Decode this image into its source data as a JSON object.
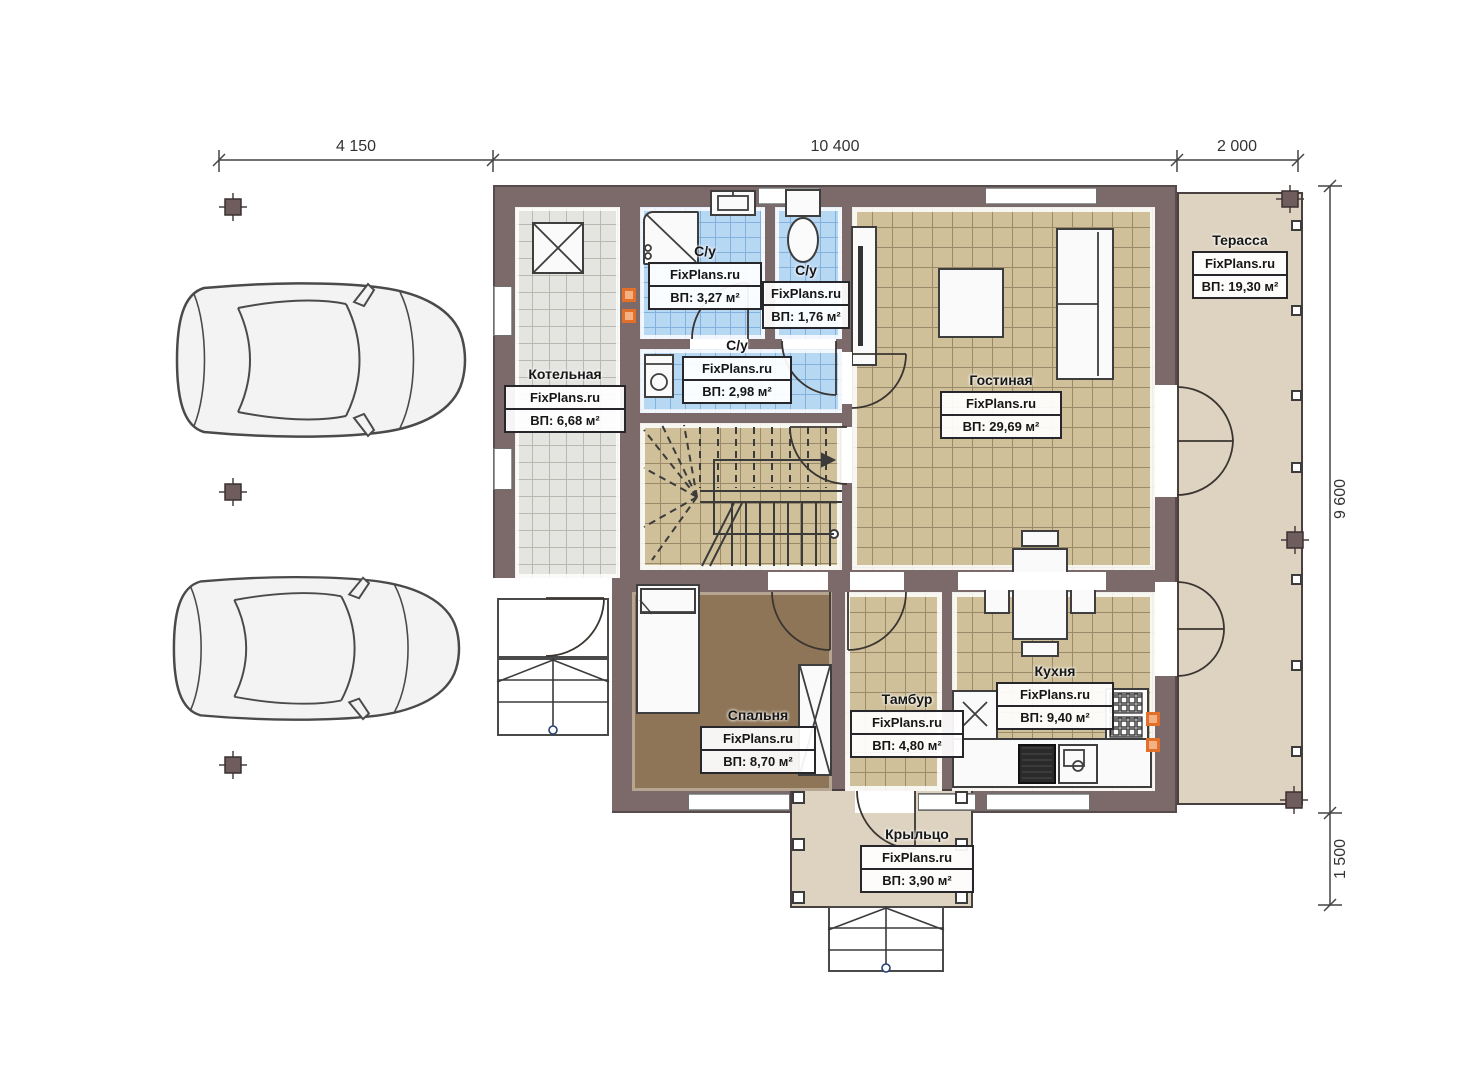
{
  "brand": "FixPlans.ru",
  "dimensions": {
    "top": [
      "4 150",
      "10 400",
      "2 000"
    ],
    "right": [
      "9 600",
      "1 500"
    ]
  },
  "rooms": [
    {
      "key": "boiler",
      "name": "Котельная",
      "area": "ВП: 6,68 м²"
    },
    {
      "key": "bath1",
      "name": "С/у",
      "area": "ВП: 3,27 м²"
    },
    {
      "key": "bath2",
      "name": "С/у",
      "area": "ВП: 1,76 м²"
    },
    {
      "key": "bath3",
      "name": "С/у",
      "area": "ВП: 2,98 м²"
    },
    {
      "key": "living",
      "name": "Гостиная",
      "area": "ВП: 29,69 м²"
    },
    {
      "key": "terrace",
      "name": "Терасса",
      "area": "ВП: 19,30 м²"
    },
    {
      "key": "bedroom",
      "name": "Спальня",
      "area": "ВП: 8,70 м²"
    },
    {
      "key": "tambour",
      "name": "Тамбур",
      "area": "ВП: 4,80 м²"
    },
    {
      "key": "kitchen",
      "name": "Кухня",
      "area": "ВП: 9,40 м²"
    },
    {
      "key": "porch",
      "name": "Крыльцо",
      "area": "ВП: 3,90 м²"
    }
  ],
  "colors": {
    "wall": "#7c6969",
    "floor_tile_tan": "#cfc099",
    "floor_tile_blue": "#b7d8f3",
    "floor_tile_gray": "#e4e4e1",
    "floor_bedroom": "#8f7557",
    "floor_terrace": "#ded3c0",
    "vent_marker": "#e2702a"
  }
}
